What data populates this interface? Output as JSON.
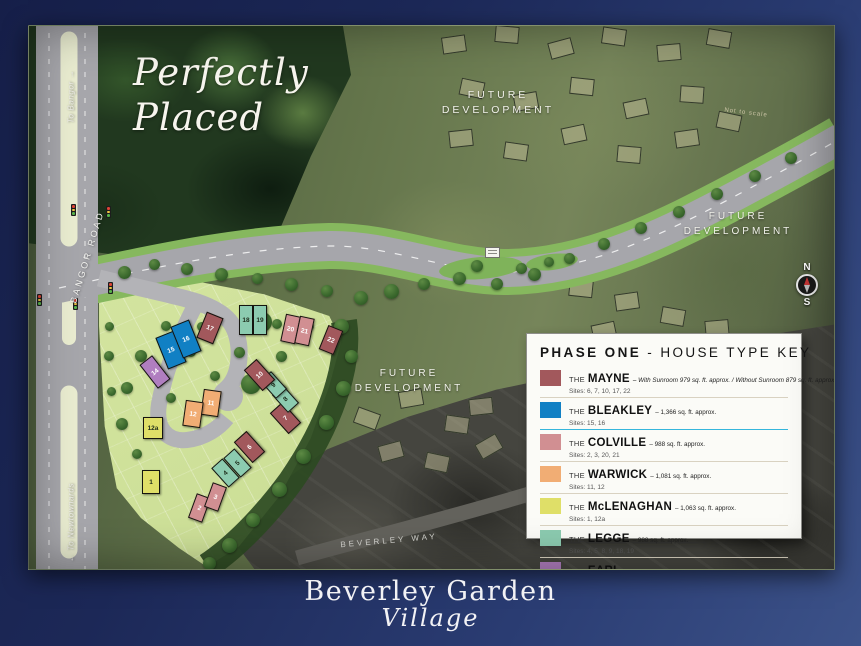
{
  "tagline": {
    "line1": "Perfectly",
    "line2": "Placed"
  },
  "labels": {
    "future_development": "FUTURE DEVELOPMENT",
    "bangor_road": "BANGOR ROAD",
    "to_bangor": "To Bangor →",
    "to_newtownards": "← To Newtownards",
    "beverley_way": "BEVERLEY WAY",
    "not_to_scale": "Not to scale",
    "compass_n": "N",
    "compass_s": "S"
  },
  "legend": {
    "title_bold": "PHASE ONE",
    "title_rest": " - HOUSE TYPE KEY",
    "rows": [
      {
        "type": "mayne",
        "the": "THE",
        "name": "MAYNE",
        "desc": "– With Sunroom 979 sq. ft. approx. / Without Sunroom 879 sq. ft. approx.",
        "italic_desc": true,
        "sites": "Sites: 6, 7, 10, 17, 22",
        "color": "#a2585c",
        "separator": "#d9d2c1"
      },
      {
        "type": "bleakley",
        "the": "THE",
        "name": "BLEAKLEY",
        "desc": "– 1,366 sq. ft. approx.",
        "italic_desc": false,
        "sites": "Sites: 15, 16",
        "color": "#1180c4",
        "separator": "#35b6dc"
      },
      {
        "type": "colville",
        "the": "THE",
        "name": "COLVILLE",
        "desc": "– 988 sq. ft. approx.",
        "italic_desc": false,
        "sites": "Sites: 2, 3, 20, 21",
        "color": "#d18f92",
        "separator": "#d9d2c1"
      },
      {
        "type": "warwick",
        "the": "THE",
        "name": "WARWICK",
        "desc": "– 1,081 sq. ft. approx.",
        "italic_desc": false,
        "sites": "Sites: 11, 12",
        "color": "#f1ad74",
        "separator": "#d9d2c1"
      },
      {
        "type": "mclenaghan",
        "the": "THE",
        "name": "McLENAGHAN",
        "desc": "– 1,063 sq. ft. approx.",
        "italic_desc": false,
        "sites": "Sites: 1, 12a",
        "color": "#dfdf68",
        "separator": "#d9d2c1"
      },
      {
        "type": "legge",
        "the": "THE",
        "name": "LEGGE",
        "desc": "– 988 sq. ft. approx.",
        "italic_desc": false,
        "sites": "Sites: 4, 5, 8, 9, 18, 19",
        "color": "#8ccbb0",
        "separator": "#d9d2c1"
      },
      {
        "type": "earl",
        "the": "THE",
        "name": "EARL",
        "desc": "– 1,089 sq. ft. approx.",
        "italic_desc": false,
        "sites": "Sites: 14",
        "color": "#b07ec0",
        "separator": "#d9d2c1"
      }
    ]
  },
  "sites": [
    {
      "num": "1",
      "type": "mclenaghan",
      "x": 122,
      "y": 456,
      "w": 18,
      "h": 24,
      "rot": 0
    },
    {
      "num": "2",
      "type": "colville",
      "x": 170,
      "y": 482,
      "w": 15,
      "h": 26,
      "rot": 20
    },
    {
      "num": "3",
      "type": "colville",
      "x": 186,
      "y": 471,
      "w": 15,
      "h": 26,
      "rot": 20
    },
    {
      "num": "4",
      "type": "legge",
      "x": 196,
      "y": 447,
      "w": 15,
      "h": 26,
      "rot": -42
    },
    {
      "num": "5",
      "type": "legge",
      "x": 208,
      "y": 437,
      "w": 15,
      "h": 26,
      "rot": -42
    },
    {
      "num": "6",
      "type": "mayne",
      "x": 220,
      "y": 421,
      "w": 17,
      "h": 28,
      "rot": -42
    },
    {
      "num": "7",
      "type": "mayne",
      "x": 256,
      "y": 392,
      "w": 17,
      "h": 28,
      "rot": -42
    },
    {
      "num": "8",
      "type": "legge",
      "x": 256,
      "y": 373,
      "w": 15,
      "h": 24,
      "rot": -42
    },
    {
      "num": "9",
      "type": "legge",
      "x": 244,
      "y": 359,
      "w": 15,
      "h": 24,
      "rot": -42
    },
    {
      "num": "10",
      "type": "mayne",
      "x": 230,
      "y": 349,
      "w": 17,
      "h": 28,
      "rot": -42
    },
    {
      "num": "11",
      "type": "warwick",
      "x": 182,
      "y": 377,
      "w": 18,
      "h": 26,
      "rot": 8
    },
    {
      "num": "12",
      "type": "warwick",
      "x": 164,
      "y": 388,
      "w": 18,
      "h": 26,
      "rot": 8
    },
    {
      "num": "12a",
      "type": "mclenaghan",
      "x": 124,
      "y": 402,
      "w": 20,
      "h": 22,
      "rot": 0
    },
    {
      "num": "14",
      "type": "earl",
      "x": 126,
      "y": 346,
      "w": 16,
      "h": 30,
      "rot": -38
    },
    {
      "num": "15",
      "type": "bleakley",
      "x": 142,
      "y": 324,
      "w": 20,
      "h": 34,
      "rot": -22
    },
    {
      "num": "16",
      "type": "bleakley",
      "x": 157,
      "y": 313,
      "w": 20,
      "h": 34,
      "rot": -22
    },
    {
      "num": "17",
      "type": "mayne",
      "x": 181,
      "y": 302,
      "w": 18,
      "h": 28,
      "rot": 22
    },
    {
      "num": "18",
      "type": "legge",
      "x": 217,
      "y": 294,
      "w": 14,
      "h": 30,
      "rot": 0
    },
    {
      "num": "19",
      "type": "legge",
      "x": 231,
      "y": 294,
      "w": 14,
      "h": 30,
      "rot": 0
    },
    {
      "num": "20",
      "type": "colville",
      "x": 261,
      "y": 303,
      "w": 15,
      "h": 28,
      "rot": 12
    },
    {
      "num": "21",
      "type": "colville",
      "x": 275,
      "y": 305,
      "w": 15,
      "h": 28,
      "rot": 12
    },
    {
      "num": "22",
      "type": "mayne",
      "x": 302,
      "y": 314,
      "w": 16,
      "h": 26,
      "rot": 22
    }
  ],
  "logo": {
    "line1": "Beverley Garden",
    "line2": "Village"
  }
}
